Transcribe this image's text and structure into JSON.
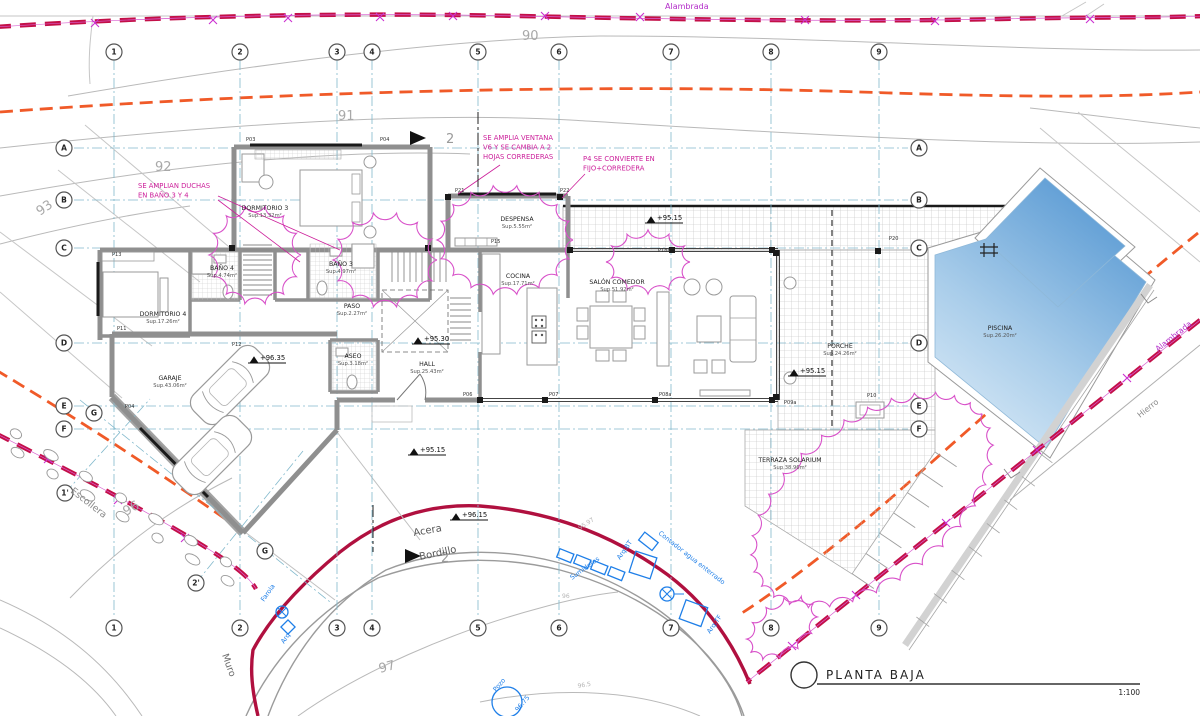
{
  "title_block": {
    "title": "PLANTA BAJA",
    "scale": "1:100"
  },
  "boundaries": {
    "alambrada_top": "Alambrada",
    "alambrada_right": "Alambrada",
    "hierro": "Hierro",
    "escollera": "Escollera",
    "muro": "Muro",
    "acera": "Acera",
    "bordillo": "Bordillo"
  },
  "utilities": {
    "sumideros": "Sumideros",
    "arq_bt": "Arq.BT",
    "arq_tf": "Arq.TF",
    "arq": "Arq",
    "farola": "Farola",
    "pozo": "Pozo",
    "pozo_level": "96.75",
    "contador": "Contador agua enterrado"
  },
  "annotations": {
    "showers": [
      "SE AMPLIAN DUCHAS",
      "EN BAÑO 3 Y 4"
    ],
    "window_v6": [
      "SE AMPLIA VENTANA",
      "V6 Y SE CAMBIA A 2",
      "HOJAS CORREDERAS"
    ],
    "door_p4": [
      "P4 SE CONVIERTE EN",
      "FIJO+CORREDERA"
    ]
  },
  "rooms": [
    {
      "name": "DORMITORIO 3",
      "area": "Sup.13.32m²"
    },
    {
      "name": "DESPENSA",
      "area": "Sup.5.55m²"
    },
    {
      "name": "COCINA",
      "area": "Sup.17.71m²"
    },
    {
      "name": "SALÓN COMEDOR",
      "area": "Sup.51.92m²"
    },
    {
      "name": "DORMITORIO 4",
      "area": "Sup.17.26m²"
    },
    {
      "name": "BAÑO 4",
      "area": "Sup.4.74m²"
    },
    {
      "name": "BAÑO 3",
      "area": "Sup.4.97m²"
    },
    {
      "name": "PASO",
      "area": "Sup.2.27m²"
    },
    {
      "name": "ASEO",
      "area": "Sup.3.18m²"
    },
    {
      "name": "HALL",
      "area": "Sup.25.43m²"
    },
    {
      "name": "GARAJE",
      "area": "Sup.43.06m²"
    },
    {
      "name": "PORCHE",
      "area": "Sup.24.26m²"
    },
    {
      "name": "TERRAZA SOLARIUM",
      "area": "Sup.38.96m²"
    },
    {
      "name": "PISCINA",
      "area": "Sup.26.20m²"
    }
  ],
  "levels": [
    "+96.35",
    "+95.30",
    "+95.15",
    "+95.15",
    "+95.15",
    "+96.15"
  ],
  "contours": [
    "90",
    "91",
    "92",
    "93",
    "96",
    "97"
  ],
  "small_levels": [
    "95.97",
    "96",
    "96.5"
  ],
  "grid": {
    "top": [
      "1",
      "2",
      "3",
      "4",
      "5",
      "6",
      "7",
      "8",
      "9"
    ],
    "bottom": [
      "1",
      "2",
      "3",
      "4",
      "5",
      "6",
      "7",
      "8",
      "9"
    ],
    "left": [
      "A",
      "B",
      "C",
      "D",
      "E",
      "F"
    ],
    "right": [
      "A",
      "B",
      "C",
      "D",
      "E",
      "F"
    ],
    "aux": [
      "G",
      "G",
      "1'",
      "2'"
    ]
  },
  "tags": [
    "P03",
    "P04",
    "P21",
    "P22",
    "P13",
    "P11",
    "P12",
    "P04",
    "P06",
    "P07",
    "P08a",
    "P09a",
    "P10",
    "P18a",
    "P20",
    "P15"
  ],
  "section_marker": "2",
  "colors": {
    "fence_crimson": "#c31048",
    "muro_red": "#b0103f",
    "orange": "#f05a28",
    "grid_cyan": "#82b9cc",
    "revision_magenta": "#d851c9",
    "annotation_magenta": "#cc1f9a",
    "utility_blue": "#1f7fe8",
    "pool_deep": "#4a90cf",
    "pool_light": "#eef6fc",
    "wall_gray": "#8f8f8f",
    "contour_gray": "#b5b5b5"
  }
}
